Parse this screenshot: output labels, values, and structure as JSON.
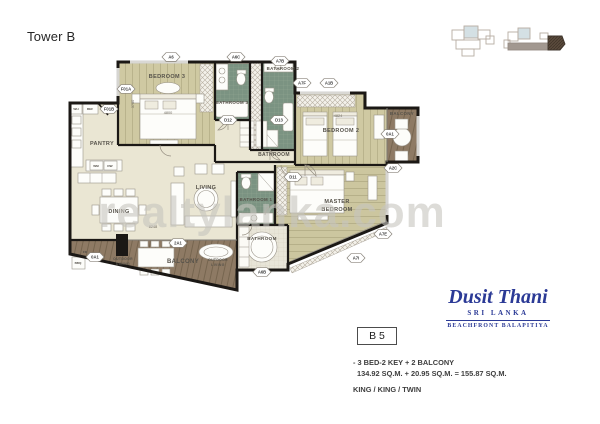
{
  "header": {
    "title": "Tower B"
  },
  "watermark": "realtylanka.com",
  "brand": {
    "name": "Dusit Thani",
    "subtitle": "SRI LANKA",
    "tagline": "BEACHFRONT BALAPITIYA"
  },
  "unit": {
    "code": "B 5",
    "type_line": "- 3 BED-2 KEY + 2 BALCONY",
    "area_line": "134.92 SQ.M. + 20.95 SQ.M. = 155.87 SQ.M.",
    "bed_line": "KING / KING / TWIN"
  },
  "plan": {
    "room_labels": [
      {
        "text": "BEDROOM 3",
        "x": 167,
        "y": 78,
        "size": 5.5
      },
      {
        "text": "BATHROOM 3",
        "x": 232,
        "y": 104,
        "size": 4.4
      },
      {
        "text": "BATHROOM 2",
        "x": 283,
        "y": 70,
        "size": 4.4
      },
      {
        "text": "PANTRY",
        "x": 102,
        "y": 145,
        "size": 5.5
      },
      {
        "text": "BEDROOM 2",
        "x": 341,
        "y": 132,
        "size": 5.5
      },
      {
        "text": "BALCONY",
        "x": 402,
        "y": 115,
        "size": 4.4
      },
      {
        "text": "BATHROOM",
        "x": 274,
        "y": 156,
        "size": 5
      },
      {
        "text": "LIVING",
        "x": 206,
        "y": 189,
        "size": 5.5
      },
      {
        "text": "DINING",
        "x": 119,
        "y": 213,
        "size": 5.5
      },
      {
        "text": "BATHROOM 1",
        "x": 256,
        "y": 201,
        "size": 4.4
      },
      {
        "text": "MASTER",
        "x": 337,
        "y": 203,
        "size": 5.5
      },
      {
        "text": "BEDROOM",
        "x": 337,
        "y": 211,
        "size": 5.5
      },
      {
        "text": "BATHROOM",
        "x": 262,
        "y": 240,
        "size": 4.6
      },
      {
        "text": "BALCONY",
        "x": 183,
        "y": 263,
        "size": 6
      },
      {
        "text": "OUTDOOR",
        "x": 123,
        "y": 260,
        "size": 3.4
      },
      {
        "text": "DINING",
        "x": 123,
        "y": 265,
        "size": 3.4
      },
      {
        "text": "OUTDOOR",
        "x": 218,
        "y": 261,
        "size": 3.4
      },
      {
        "text": "LIVING",
        "x": 218,
        "y": 266,
        "size": 3.4
      }
    ],
    "markers": [
      {
        "text": "A6",
        "x": 171,
        "y": 57
      },
      {
        "text": "A6C",
        "x": 236,
        "y": 57
      },
      {
        "text": "A7B",
        "x": 280,
        "y": 61
      },
      {
        "text": "A7F",
        "x": 302,
        "y": 83
      },
      {
        "text": "A1B",
        "x": 329,
        "y": 83
      },
      {
        "text": "F01A",
        "x": 126,
        "y": 89
      },
      {
        "text": "F01B",
        "x": 109,
        "y": 109
      },
      {
        "text": "D12",
        "x": 228,
        "y": 120
      },
      {
        "text": "D13",
        "x": 279,
        "y": 120
      },
      {
        "text": "D11",
        "x": 293,
        "y": 177
      },
      {
        "text": "0A1",
        "x": 390,
        "y": 134
      },
      {
        "text": "A2C",
        "x": 393,
        "y": 168
      },
      {
        "text": "A7E",
        "x": 383,
        "y": 234
      },
      {
        "text": "A7I",
        "x": 356,
        "y": 258
      },
      {
        "text": "A6B",
        "x": 262,
        "y": 272
      },
      {
        "text": "2A1",
        "x": 178,
        "y": 243
      },
      {
        "text": "0A1",
        "x": 95,
        "y": 257
      }
    ],
    "dim_labels": [
      {
        "text": "4800",
        "x": 168,
        "y": 114
      },
      {
        "text": "4824",
        "x": 338,
        "y": 117
      },
      {
        "text": "8248",
        "x": 153,
        "y": 228
      },
      {
        "text": "3750",
        "x": 134,
        "y": 104,
        "rot": -90
      }
    ],
    "fixture_labels": [
      {
        "text": "WH",
        "x": 76,
        "y": 110
      },
      {
        "text": "REF",
        "x": 90,
        "y": 110
      },
      {
        "text": "WM",
        "x": 96,
        "y": 167
      },
      {
        "text": "DW",
        "x": 110,
        "y": 167
      },
      {
        "text": "BBQ",
        "x": 78,
        "y": 264
      },
      {
        "text": "FD",
        "x": 85,
        "y": 253
      }
    ]
  },
  "colors": {
    "brand_blue": "#2b3a96",
    "wall": "#1b1815",
    "wood_floor": "#cfc9a2",
    "bath_tile": "#7b9382",
    "deck": "#8e7a64",
    "main_floor": "#eae6d3",
    "watermark_gray": "#c7c5bf"
  }
}
